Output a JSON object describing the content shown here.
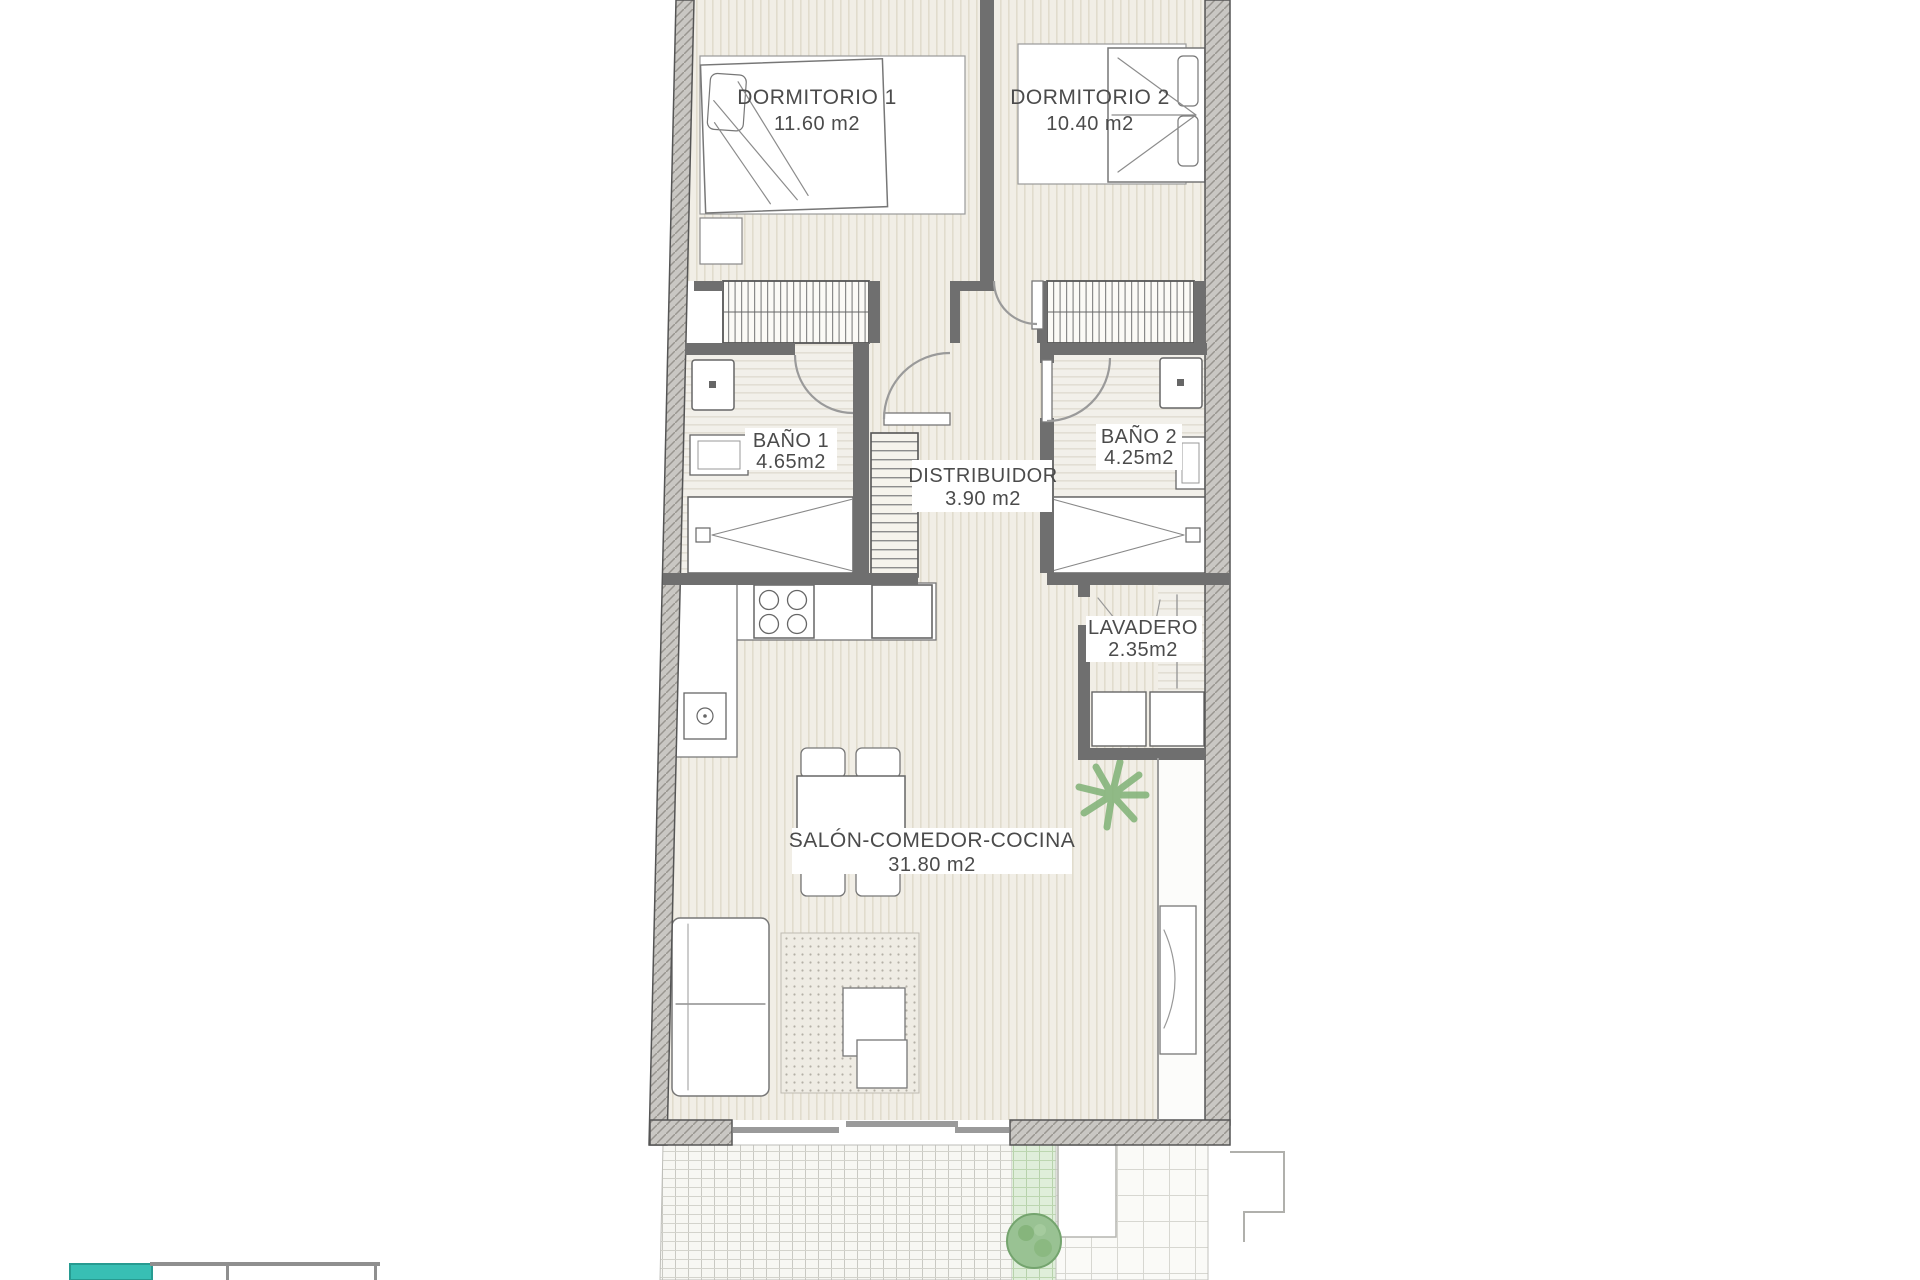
{
  "plan": {
    "type": "apartment-floor-plan",
    "rooms": [
      {
        "id": "dormitorio-1",
        "name": "DORMITORIO 1",
        "area": "11.60 m2"
      },
      {
        "id": "dormitorio-2",
        "name": "DORMITORIO 2",
        "area": "10.40 m2"
      },
      {
        "id": "bano-1",
        "name": "BAÑO 1",
        "area": "4.65m2"
      },
      {
        "id": "bano-2",
        "name": "BAÑO 2",
        "area": "4.25m2"
      },
      {
        "id": "distribuidor",
        "name": "DISTRIBUIDOR",
        "area": "3.90 m2"
      },
      {
        "id": "lavadero",
        "name": "LAVADERO",
        "area": "2.35m2"
      },
      {
        "id": "salon",
        "name": "SALÓN-COMEDOR-COCINA",
        "area": "31.80 m2"
      }
    ],
    "colors": {
      "teal_accent": "#38bfb4",
      "plant_green": "#86b57c",
      "bush_green": "#99c293",
      "wall_gray": "#c9c7c3"
    },
    "icons": [
      "plant-icon",
      "bush-icon"
    ]
  }
}
